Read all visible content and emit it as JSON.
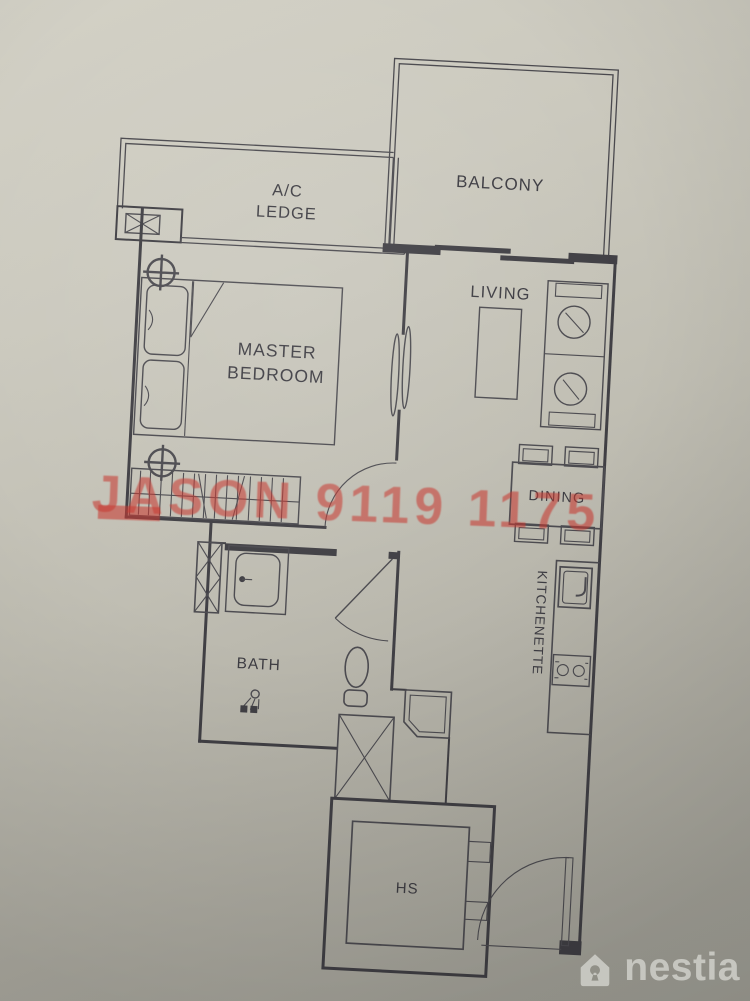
{
  "floorplan": {
    "rooms": {
      "balcony": {
        "label": "BALCONY"
      },
      "ac_ledge": {
        "line1": "A/C",
        "line2": "LEDGE"
      },
      "master_bedroom": {
        "line1": "MASTER",
        "line2": "BEDROOM"
      },
      "living": {
        "label": "LIVING"
      },
      "dining": {
        "label": "DINING"
      },
      "kitchenette": {
        "label": "KITCHENETTE"
      },
      "bath": {
        "label": "BATH"
      },
      "household_shelter": {
        "label": "HS"
      }
    },
    "line_color": "#403f44",
    "paper_color": "#c0beb3"
  },
  "watermark": {
    "text": "JASON 9119 1175",
    "color": "#c7372f"
  },
  "brand": {
    "name": "nestia",
    "color": "#ebebe5",
    "icon": "house-keyhole-icon"
  }
}
